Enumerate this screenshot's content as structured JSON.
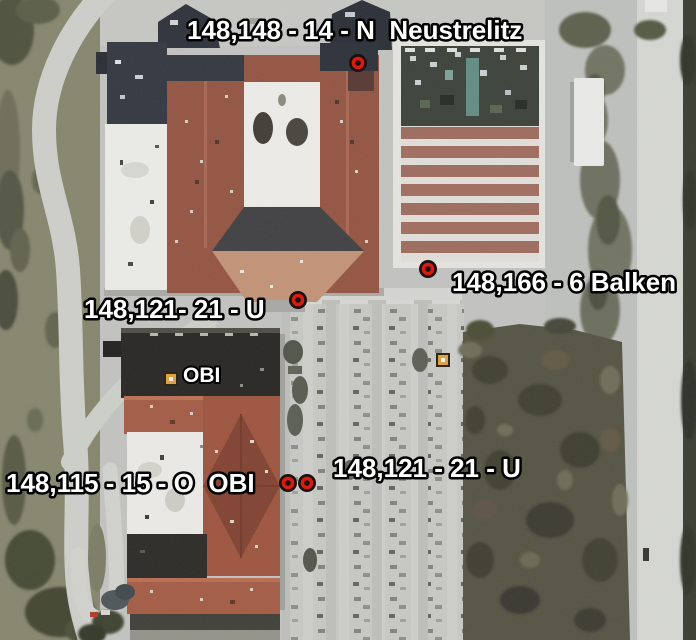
{
  "scene": {
    "kind": "aerial-satellite-view"
  },
  "placemarks": [
    {
      "label": "148,148 - 14 - N  Neustrelitz",
      "marker": "red-dot-marker"
    },
    {
      "label": "148,166 - 6 Balken",
      "marker": "red-dot-marker"
    },
    {
      "label": "148,121- 21 - U",
      "marker": "red-dot-marker"
    },
    {
      "label": "OBI",
      "marker": "orange-square-marker"
    },
    {
      "label": "148,115 - 15 - O  OBI",
      "marker": "red-dot-pair-marker"
    },
    {
      "label": "148,121 - 21 - U",
      "marker": "none"
    },
    {
      "label": "",
      "marker": "orange-square-marker"
    }
  ],
  "colors": {
    "label_text": "#ffffff",
    "label_outline": "#000000",
    "marker_red": "#d91c12",
    "marker_dark_ring": "#1d100d",
    "marker_orange": "#e0a140",
    "roof_red": "#92503d",
    "roof_white": "#eeeeea",
    "roof_dark": "#211f1c"
  }
}
